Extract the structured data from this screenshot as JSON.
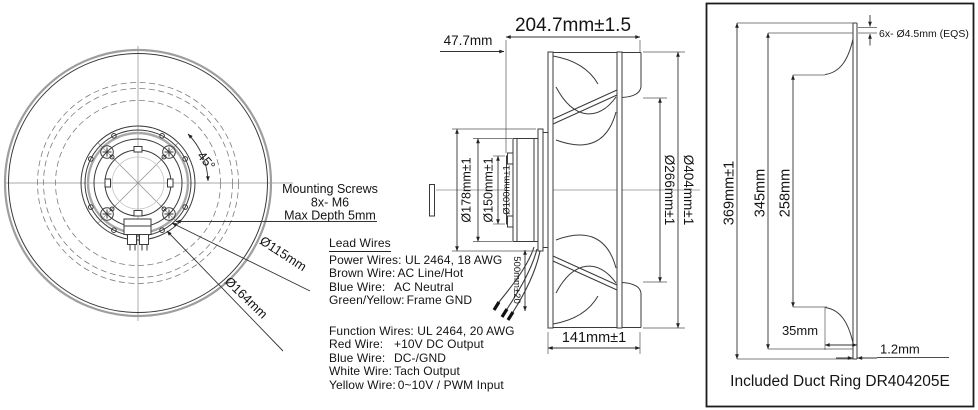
{
  "front_view": {
    "angle": "45°",
    "bolt_circle_dia": "Ø115mm",
    "outer_circle_dia": "Ø164mm",
    "mounting_screws": {
      "line1": "Mounting Screws",
      "line2": "8x- M6",
      "line3": "Max Depth 5mm"
    }
  },
  "lead_wires": {
    "title": "Lead Wires",
    "power_header": "Power Wires: UL 2464, 18 AWG",
    "power_rows": [
      {
        "label": "Brown Wire:",
        "value": "AC Line/Hot"
      },
      {
        "label": "Blue Wire:",
        "value": "AC Neutral"
      },
      {
        "label": "Green/Yellow:",
        "value": "Frame GND"
      }
    ],
    "function_header": "Function Wires: UL 2464, 20 AWG",
    "function_rows": [
      {
        "label": "Red Wire:",
        "value": "+10V DC Output"
      },
      {
        "label": "Blue Wire:",
        "value": "DC-/GND"
      },
      {
        "label": "White Wire:",
        "value": "Tach Output"
      },
      {
        "label": "Yellow Wire:",
        "value": "0~10V / PWM Input"
      }
    ]
  },
  "side_view": {
    "overall_depth": "204.7mm±1.5",
    "motor_depth": "47.7mm",
    "flange_dia": "Ø178mm±1",
    "motor_dia": "Ø150mm±1",
    "hub_dia": "Ø100mm±1",
    "impeller_dia": "Ø404mm±1",
    "inlet_dia": "Ø266mm±1",
    "impeller_depth": "141mm±1",
    "wire_length": "500mm±20"
  },
  "duct_ring": {
    "holes": "6x- Ø4.5mm (EQS)",
    "outer_dia": "369mm±1",
    "bore_dia": "345mm",
    "inner_dia": "258mm",
    "flange_depth": "35mm",
    "wall_thickness": "1.2mm",
    "caption": "Included Duct Ring DR404205E"
  }
}
